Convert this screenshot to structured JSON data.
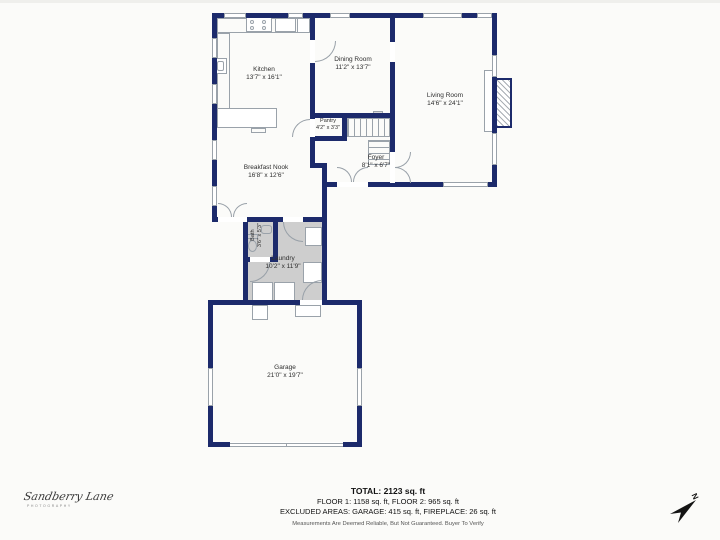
{
  "meta": {
    "wall_color": "#1c2a6b",
    "line_gray": "#9aa2aa",
    "floor_gray": "#cecece",
    "background": "#fbfbf9"
  },
  "rooms": {
    "kitchen": {
      "name": "Kitchen",
      "dims": "13'7\" x 16'1\""
    },
    "dining": {
      "name": "Dining Room",
      "dims": "11'2\" x 13'7\""
    },
    "living": {
      "name": "Living Room",
      "dims": "14'6\" x 24'1\""
    },
    "pantry": {
      "name": "Pantry",
      "dims": "4'2\" x 3'3\""
    },
    "foyer": {
      "name": "Foyer",
      "dims": "8'1\" x 6'7\""
    },
    "breakfast_nook": {
      "name": "Breakfast Nook",
      "dims": "16'8\" x 12'6\""
    },
    "bath": {
      "name": "Bath",
      "dims": "3'6\" x 5'3\""
    },
    "laundry": {
      "name": "Laundry",
      "dims": "10'2\" x 11'9\""
    },
    "garage": {
      "name": "Garage",
      "dims": "21'0\" x 19'7\""
    }
  },
  "summary": {
    "total": "TOTAL: 2123 sq. ft",
    "floors": "FLOOR 1: 1158 sq. ft, FLOOR 2: 965 sq. ft",
    "excluded": "EXCLUDED AREAS: GARAGE: 415 sq. ft, FIREPLACE: 26 sq. ft",
    "disclaimer": "Measurements Are Deemed Reliable, But Not Guaranteed. Buyer To Verify"
  },
  "branding": {
    "logo_script": "Sandberry Lane",
    "logo_sub": "PHOTOGRAPHY"
  },
  "compass": {
    "label": "N"
  }
}
